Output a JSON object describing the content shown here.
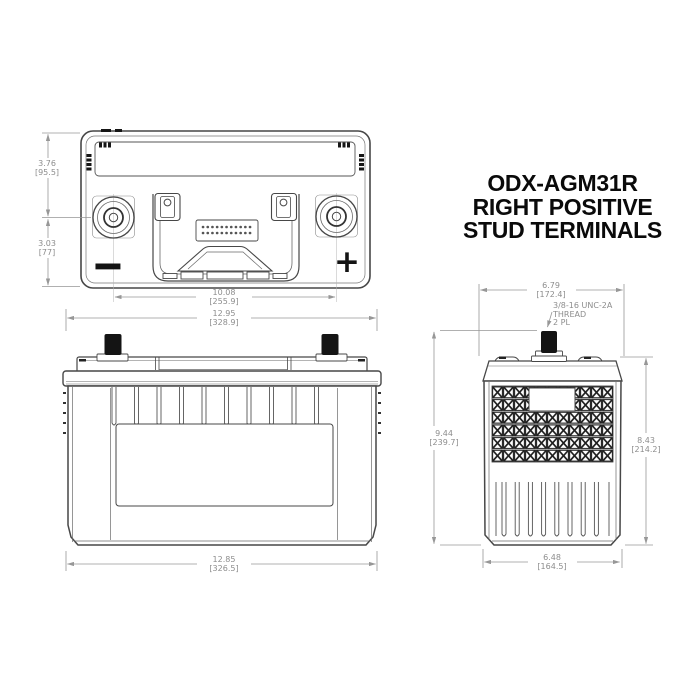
{
  "drawing": {
    "title": {
      "line1": "ODX-AGM31R",
      "line2": "RIGHT POSITIVE",
      "line3": "STUD TERMINALS"
    },
    "top_view": {
      "polarity": {
        "negative": "−",
        "positive": "+"
      },
      "dims": {
        "terminal_offset_top": {
          "in": "3.76",
          "mm": "[95.5]"
        },
        "terminal_offset_bottom": {
          "in": "3.03",
          "mm": "[77]"
        },
        "terminal_spacing": {
          "in": "10.08",
          "mm": "[255.9]"
        },
        "overall_length": {
          "in": "12.95",
          "mm": "[328.9]"
        }
      }
    },
    "front_view": {
      "dims": {
        "container_length": {
          "in": "12.85",
          "mm": "[326.5]"
        }
      }
    },
    "side_view": {
      "thread_callout": {
        "line1": "3/8-16 UNC-2A",
        "line2": "THREAD",
        "line3": "2 PL"
      },
      "dims": {
        "lid_width": {
          "in": "6.79",
          "mm": "[172.4]"
        },
        "overall_height": {
          "in": "9.44",
          "mm": "[239.7]"
        },
        "container_height": {
          "in": "8.43",
          "mm": "[214.2]"
        },
        "container_width": {
          "in": "6.48",
          "mm": "[164.5]"
        }
      }
    },
    "colors": {
      "line_ink": "#474747",
      "dimension_gray": "#979797",
      "text_gray": "#8d8d8d",
      "terminal_black": "#141414",
      "background": "#ffffff"
    }
  }
}
